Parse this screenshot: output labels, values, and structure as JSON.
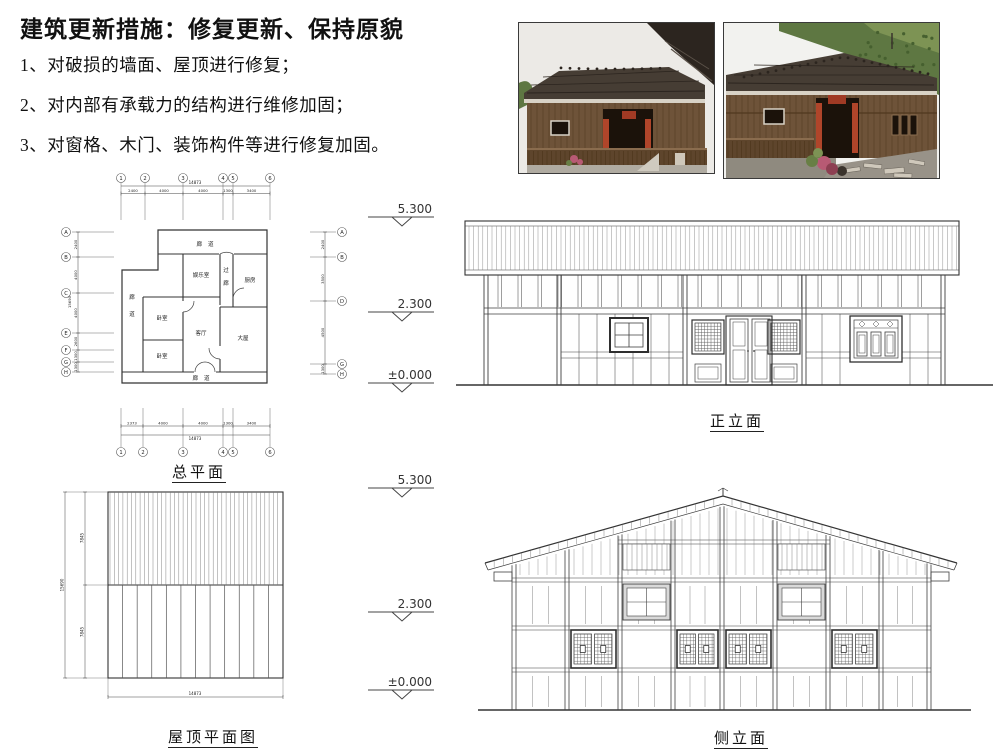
{
  "header": {
    "title": "建筑更新措施：修复更新、保持原貌"
  },
  "measures": [
    "1、对破损的墙面、屋顶进行修复；",
    "2、对内部有承载力的结构进行维修加固；",
    "3、对窗格、木门、装饰构件等进行修复加固。"
  ],
  "photos": {
    "palette": {
      "sky": "#eceae6",
      "hill": "#5e7742",
      "hill_light": "#7d9354",
      "roof": "#463d34",
      "roof_dark": "#2c251f",
      "wood": "#6e5339",
      "wood_dark": "#50381f",
      "doorway": "#1b120a",
      "banner_red": "#b0452a",
      "sign_red": "#a03a24",
      "railing": "#5e452c",
      "deck": "#b0aba1",
      "rubble": "#989288",
      "flower": "#b85a74",
      "leaf": "#687f45",
      "frame_light": "#d8d2c6"
    }
  },
  "floor_plan": {
    "label": "总平面",
    "rooms": [
      "廊道",
      "娱乐室",
      "过廊",
      "厨房",
      "廊道",
      "卧室",
      "客厅",
      "卧室",
      "大屋",
      "廊道"
    ],
    "grid_cols": [
      "1",
      "2",
      "3",
      "4",
      "5",
      "6"
    ],
    "grid_rows_left": [
      "A",
      "B",
      "C",
      "E",
      "F",
      "G",
      "H"
    ],
    "grid_rows_right": [
      "A",
      "B",
      "D",
      "G",
      "H"
    ],
    "dims_top": {
      "total": "14873",
      "segments": [
        "2400",
        "4000",
        "4000",
        "1300",
        "3400"
      ]
    },
    "dims_bottom": {
      "total": "14873",
      "segments": [
        "2373",
        "4000",
        "4000",
        "1300",
        "3400"
      ]
    },
    "dims_left": {
      "total": "15690",
      "segments": [
        "2400",
        "4000",
        "4000",
        "2600",
        "1300",
        "1300"
      ]
    },
    "dims_right": {
      "segments": [
        "2400",
        "3500",
        "4500",
        "1300"
      ]
    }
  },
  "roof_plan": {
    "label": "屋顶平面图",
    "dims_left": {
      "total": "15690",
      "segments": [
        "7845",
        "7845"
      ]
    },
    "dim_bottom": "14873"
  },
  "front_elevation": {
    "label": "正立面",
    "levels": [
      "5.300",
      "2.300",
      "±0.000"
    ]
  },
  "side_elevation": {
    "label": "侧立面",
    "levels": [
      "5.300",
      "2.300",
      "±0.000"
    ]
  }
}
